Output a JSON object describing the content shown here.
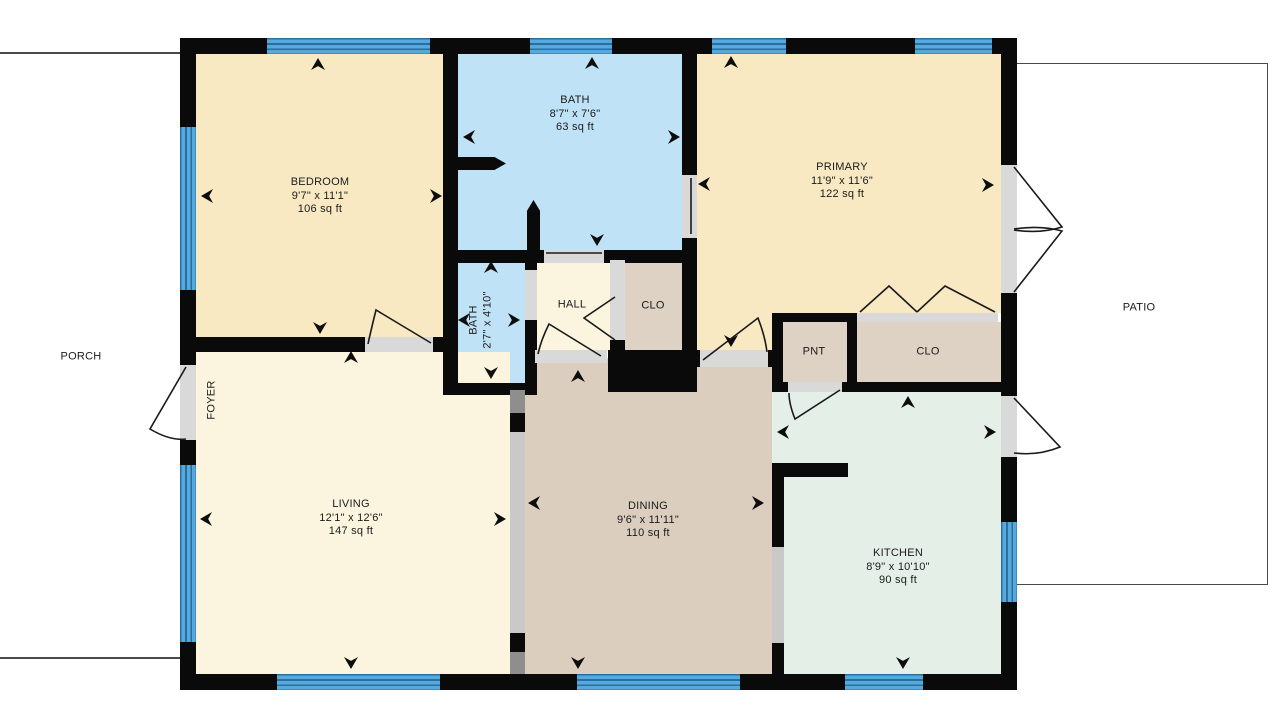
{
  "title": "Single-story house floor plan with porch and patio",
  "colors": {
    "wall": "#0a0a0a",
    "bedroom_cream": "#F8E9C3",
    "living_cream": "#FBF4DE",
    "bath_blue": "#BFE2F6",
    "dining_tan": "#DBCEBF",
    "closet_tan": "#DDD2C3",
    "kitchen_mint": "#E4EFE8",
    "window_blue": "#55A9DD",
    "window_line": "#2A6E9E",
    "door_opening_gray": "#D9D9D9",
    "cased_opening_gray": "#C9C9C9",
    "cased_post_gray": "#8E8E8E"
  },
  "icons": {
    "dimension_arrow": "concave black arrowhead pointing at wall"
  },
  "rooms": {
    "bedroom": {
      "name": "BEDROOM",
      "dims": "9'7\" x 11'1\"",
      "area": "106 sq ft"
    },
    "bath": {
      "name": "BATH",
      "dims": "8'7\" x 7'6\"",
      "area": "63 sq ft"
    },
    "primary": {
      "name": "PRIMARY",
      "dims": "11'9\" x 11'6\"",
      "area": "122 sq ft"
    },
    "small_bath": {
      "name": "BATH",
      "dims": "2'7\" x 4'10\""
    },
    "hall": {
      "name": "HALL"
    },
    "hall_closet": {
      "name": "CLO"
    },
    "pantry": {
      "name": "PNT"
    },
    "kitchen_closet": {
      "name": "CLO"
    },
    "living": {
      "name": "LIVING",
      "dims": "12'1\" x 12'6\"",
      "area": "147 sq ft"
    },
    "dining": {
      "name": "DINING",
      "dims": "9'6\" x 11'11\"",
      "area": "110 sq ft"
    },
    "kitchen": {
      "name": "KITCHEN",
      "dims": "8'9\" x 10'10\"",
      "area": "90 sq ft"
    },
    "foyer": {
      "name": "FOYER"
    }
  },
  "outdoor": {
    "porch": {
      "label": "PORCH"
    },
    "patio": {
      "label": "PATIO"
    }
  }
}
